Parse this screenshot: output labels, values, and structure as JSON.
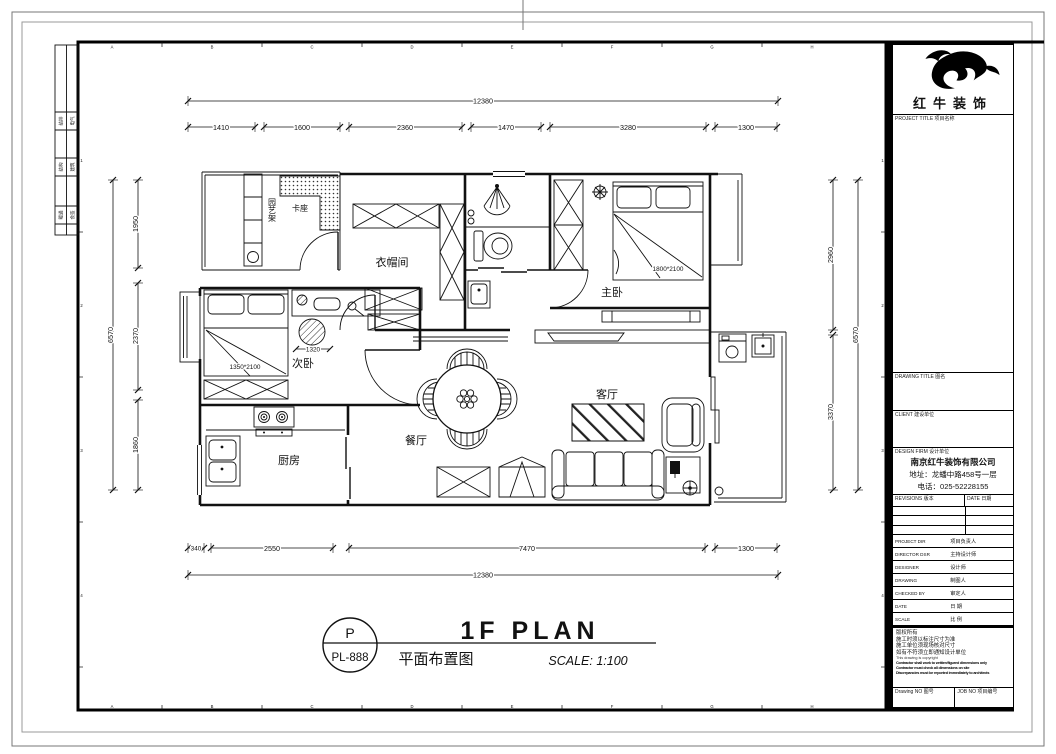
{
  "sheet": {
    "grid_letters": [
      "A",
      "B",
      "C",
      "D",
      "E",
      "F",
      "G",
      "H"
    ],
    "grid_numbers": [
      "1",
      "2",
      "3",
      "4"
    ],
    "signoff": [
      "给排",
      "电气",
      "结构",
      "建筑",
      "暖通",
      "会签"
    ]
  },
  "titleblock": {
    "brand": "红牛装饰",
    "project_title_label": "PROJECT TITLE 项目名称",
    "drawing_title_label": "DRAWING TITLE 图名",
    "client_label": "CLIENT 建设单位",
    "design_firm_label": "DESIGN FIRM 设计单位",
    "firm_name": "南京红牛装饰有限公司",
    "firm_address": "地址：龙蟠中路458号一层",
    "firm_phone": "电话：025-52228155",
    "revisions_label": "REVISIONS 版本",
    "revisions_date_label": "DATE 日期",
    "rows": [
      {
        "en": "PROJECT DIR",
        "cn": "项目负责人"
      },
      {
        "en": "DIRECTOR DSR",
        "cn": "主持设计师"
      },
      {
        "en": "DESIGNER",
        "cn": "设计师"
      },
      {
        "en": "DRAWING",
        "cn": "制图人"
      },
      {
        "en": "CHECKED BY",
        "cn": "审定人"
      },
      {
        "en": "DATE",
        "cn": "日  期"
      },
      {
        "en": "SCALE",
        "cn": "比  例"
      }
    ],
    "copyright_lines": [
      "版权所有",
      "施工时须以标注尺寸为准",
      "施工单位须现场核对尺寸",
      "如有不符须立即通知设计单位",
      "This drawing is copyright",
      "Contractor shall work to written/figured dimensions only",
      "Contractor must check all dimensions on site",
      "Discrepancies must be reported immediately to architects"
    ],
    "drawing_no_label": "Drawing NO 图号",
    "job_no_label": "JOB NO 项目编号"
  },
  "stamp": {
    "letter": "P",
    "code": "PL-888",
    "title_en": "1F PLAN",
    "title_cn": "平面布置图",
    "scale_text": "SCALE: 1:100"
  },
  "plan": {
    "rooms": {
      "master": "主卧",
      "second": "次卧",
      "closet": "衣帽间",
      "kitchen": "厨房",
      "dining": "餐厅",
      "living": "客厅",
      "booth": "卡座",
      "garden_rack": "园艺架"
    },
    "bed_master": "1800*2100",
    "bed_second": "1350*2100",
    "dim_inner": "1320",
    "dims": {
      "top_total": "12380",
      "bottom_total": "12380",
      "top": [
        "1410",
        "1600",
        "2360",
        "1470",
        "3280",
        "1300"
      ],
      "bottom": [
        "340",
        "2550",
        "7470",
        "1300"
      ],
      "left_total": "6570",
      "right_total": "6570",
      "left": [
        "1950",
        "2370",
        "1860"
      ],
      "right": [
        "2960",
        "3370"
      ]
    }
  }
}
